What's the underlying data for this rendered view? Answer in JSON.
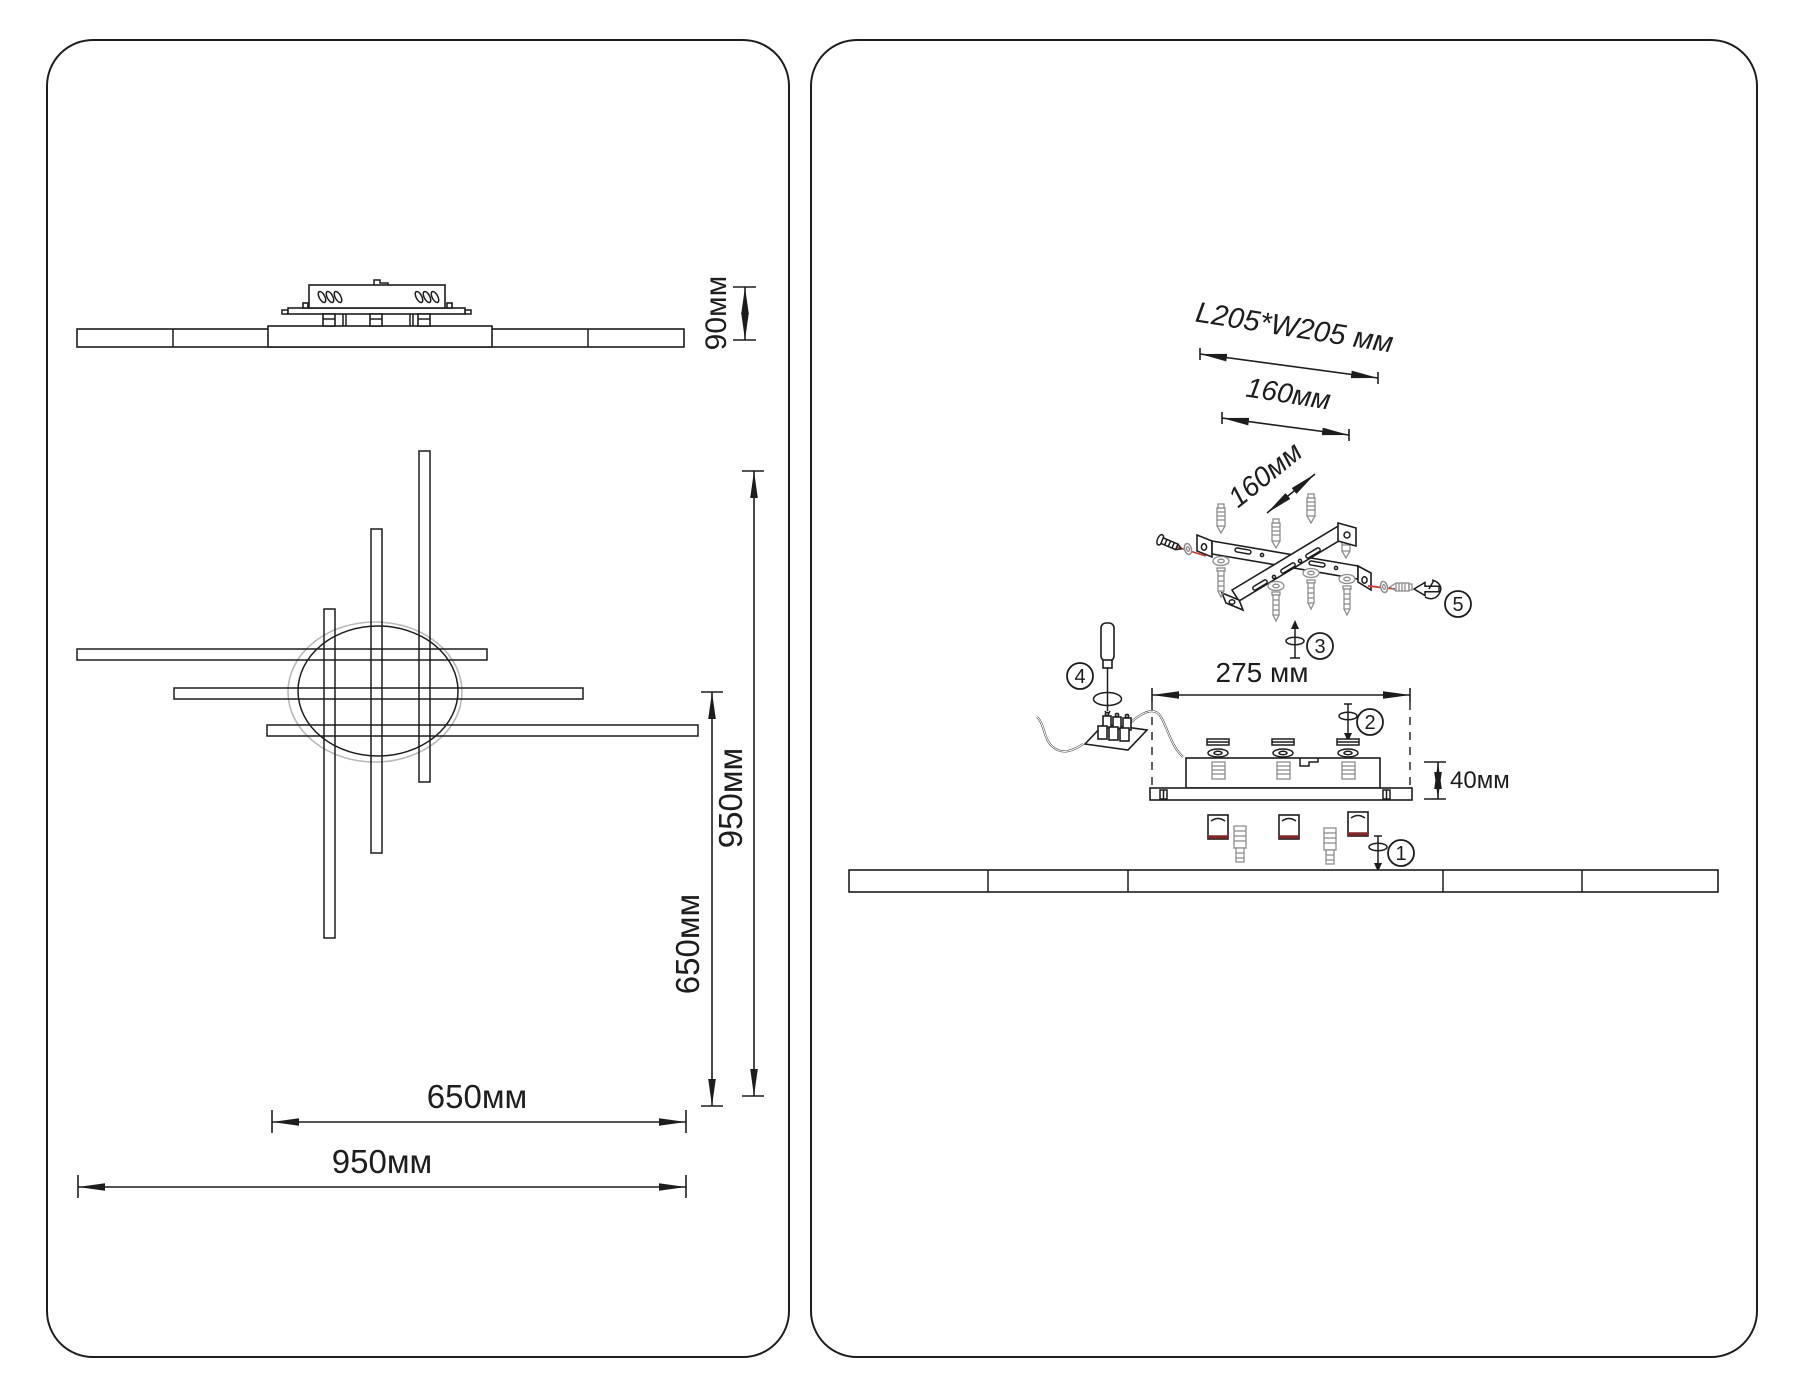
{
  "panels": {
    "left": {
      "side_view": {
        "height_label": "90мм"
      },
      "top_view": {
        "overall_height_label": "950мм",
        "inner_height_label": "650мм",
        "inner_width_label": "650мм",
        "overall_width_label": "950мм"
      }
    },
    "right": {
      "bracket": {
        "plate_label": "L205*W205 мм",
        "hole_span_label": "160мм",
        "hole_span_diagonal_label": "160мм"
      },
      "driver": {
        "width_label": "275 мм",
        "height_label": "40мм"
      },
      "steps": [
        {
          "number": "1"
        },
        {
          "number": "2"
        },
        {
          "number": "3"
        },
        {
          "number": "4"
        },
        {
          "number": "5"
        }
      ]
    }
  },
  "colors": {
    "line": "#1d1d1d",
    "hardware": "#8d8d8d",
    "guide_red": "#cf3732",
    "clip_red": "#7e2726",
    "circle_faint": "#b9b9b9"
  }
}
